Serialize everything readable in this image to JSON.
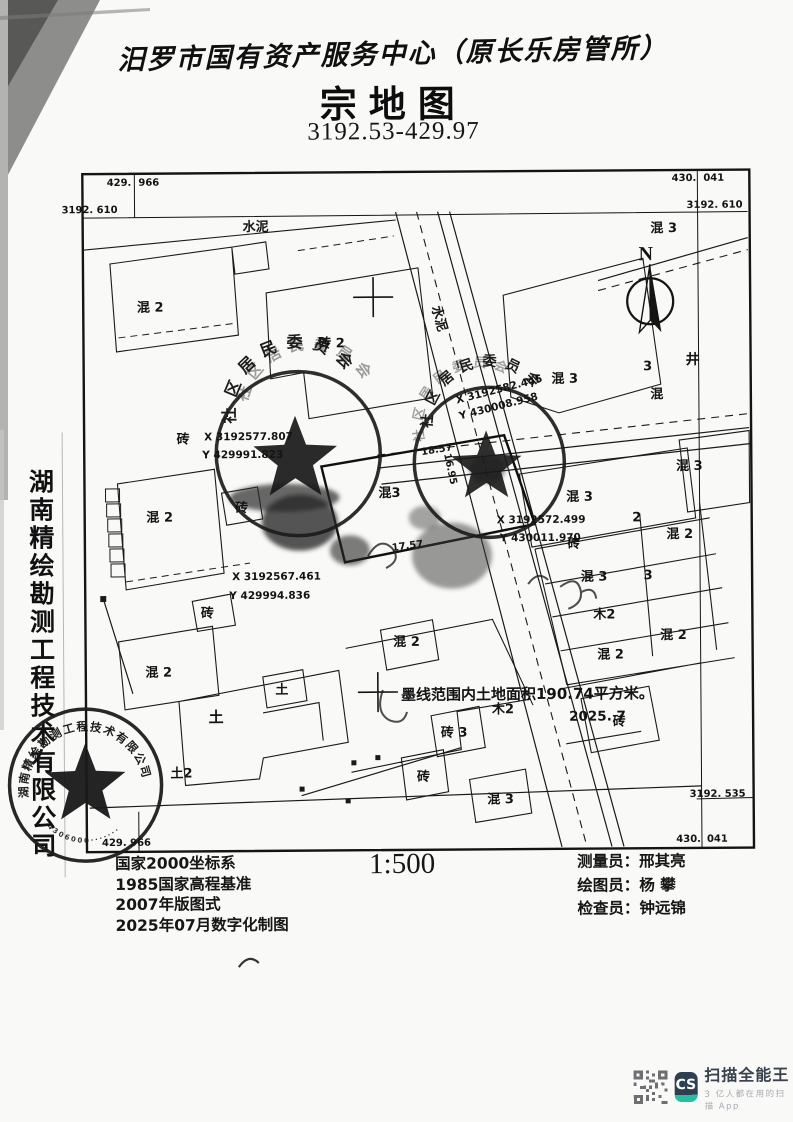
{
  "header": {
    "handwritten_title": "汨罗市国有资产服务中心（原长乐房管所）",
    "map_type": "宗地图",
    "sheet_number": "3192.53-429.97"
  },
  "sidebar": {
    "company_vertical": "湖南精绘勘测工程技术有限公司"
  },
  "map": {
    "north_label": "N",
    "stamps": {
      "left_arc": "社区居民委员会",
      "right_arc": "社区居民委员会",
      "company_arc": "湖南精绘勘测工程技术有限公司",
      "company_number": "4306000·······"
    },
    "labels": [
      {
        "t": "水泥",
        "x": 258,
        "y": 230
      },
      {
        "t": "水泥",
        "x": 437,
        "y": 320,
        "r": 74
      },
      {
        "t": "混 2",
        "x": 152,
        "y": 310
      },
      {
        "t": "砖 2",
        "x": 333,
        "y": 347
      },
      {
        "t": "混 3",
        "x": 666,
        "y": 234
      },
      {
        "t": "混 3",
        "x": 566,
        "y": 384
      },
      {
        "t": "3",
        "x": 649,
        "y": 372
      },
      {
        "t": "混",
        "x": 658,
        "y": 400
      },
      {
        "t": "井",
        "x": 694,
        "y": 366,
        "s": 14
      },
      {
        "t": "混 3",
        "x": 690,
        "y": 472
      },
      {
        "t": "砖",
        "x": 184,
        "y": 442
      },
      {
        "t": "混 2",
        "x": 160,
        "y": 520
      },
      {
        "t": "砖",
        "x": 242,
        "y": 511
      },
      {
        "t": "混3",
        "x": 390,
        "y": 497
      },
      {
        "t": "混 3",
        "x": 580,
        "y": 502
      },
      {
        "t": "2",
        "x": 637,
        "y": 523
      },
      {
        "t": "砖",
        "x": 574,
        "y": 549
      },
      {
        "t": "混 2",
        "x": 680,
        "y": 540
      },
      {
        "t": "混 3",
        "x": 594,
        "y": 582
      },
      {
        "t": "3",
        "x": 648,
        "y": 581
      },
      {
        "t": "木2",
        "x": 604,
        "y": 620
      },
      {
        "t": "混 2",
        "x": 673,
        "y": 641
      },
      {
        "t": "混 2",
        "x": 610,
        "y": 660
      },
      {
        "t": "砖",
        "x": 207,
        "y": 616
      },
      {
        "t": "混 2",
        "x": 158,
        "y": 675
      },
      {
        "t": "混 2",
        "x": 406,
        "y": 646
      },
      {
        "t": "土",
        "x": 215,
        "y": 721,
        "s": 15
      },
      {
        "t": "土",
        "x": 281,
        "y": 693
      },
      {
        "t": "土2",
        "x": 180,
        "y": 776
      },
      {
        "t": "木2",
        "x": 502,
        "y": 714
      },
      {
        "t": "砖 3",
        "x": 453,
        "y": 737
      },
      {
        "t": "砖",
        "x": 618,
        "y": 727
      },
      {
        "t": "砖",
        "x": 422,
        "y": 781
      },
      {
        "t": "混 3",
        "x": 499,
        "y": 804
      },
      {
        "t": "N",
        "x": 648,
        "y": 262,
        "s": 20,
        "serif": true
      },
      {
        "t": "X 3192577.807",
        "x": 205,
        "y": 439,
        "k": "coord"
      },
      {
        "t": "Y 429991.823",
        "x": 203,
        "y": 457,
        "k": "coord"
      },
      {
        "t": "X 3192582.445",
        "x": 458,
        "y": 404,
        "r": -14,
        "k": "coord"
      },
      {
        "t": "Y 430008.958",
        "x": 461,
        "y": 420,
        "r": -14,
        "k": "coord"
      },
      {
        "t": "X 3192572.499",
        "x": 497,
        "y": 524,
        "k": "coord"
      },
      {
        "t": "Y 430011.970",
        "x": 500,
        "y": 542,
        "k": "coord"
      },
      {
        "t": "X 3192567.461",
        "x": 232,
        "y": 579,
        "k": "coord"
      },
      {
        "t": "Y 429994.836",
        "x": 229,
        "y": 598,
        "k": "coord"
      },
      {
        "t": "18.57",
        "x": 438,
        "y": 453,
        "r": -9,
        "k": "len"
      },
      {
        "t": "17.57",
        "x": 408,
        "y": 549,
        "r": -7,
        "k": "len"
      },
      {
        "t": "16.95",
        "x": 448,
        "y": 470,
        "r": 78,
        "k": "len"
      },
      {
        "t": "429.",
        "x": 134,
        "y": 184,
        "a": "end",
        "k": "corner"
      },
      {
        "t": "966",
        "x": 141,
        "y": 184,
        "k": "corner"
      },
      {
        "t": "3192. 610",
        "x": 64,
        "y": 211,
        "k": "corner"
      },
      {
        "t": "430.",
        "x": 699,
        "y": 183,
        "a": "end",
        "k": "corner"
      },
      {
        "t": "041",
        "x": 706,
        "y": 183,
        "k": "corner"
      },
      {
        "t": "3192. 610",
        "x": 745,
        "y": 210,
        "a": "end",
        "k": "corner"
      },
      {
        "t": "3192. 535",
        "x": 744,
        "y": 799,
        "a": "end",
        "k": "corner"
      },
      {
        "t": "430.",
        "x": 699,
        "y": 844,
        "a": "end",
        "k": "corner"
      },
      {
        "t": "041",
        "x": 705,
        "y": 844,
        "k": "corner"
      },
      {
        "t": "429. 966",
        "x": 100,
        "y": 844,
        "k": "corner"
      },
      {
        "t": "墨线范围内土地面积190.74平方米。",
        "x": 400,
        "y": 700,
        "s": 15,
        "k": "note"
      },
      {
        "t": "2025. 7",
        "x": 568,
        "y": 722,
        "s": 13.5,
        "k": "note"
      }
    ]
  },
  "footer": {
    "scale": "1:500",
    "specs": [
      "国家2000坐标系",
      "1985国家高程基准",
      "2007年版图式",
      "2025年07月数字化制图"
    ],
    "staff": [
      {
        "role": "测量员：",
        "name": "邢其亮"
      },
      {
        "role": "绘图员：",
        "name": "杨  攀"
      },
      {
        "role": "检查员：",
        "name": "钟远锦"
      }
    ]
  },
  "watermark": {
    "logo": "CS",
    "brand": "扫描全能王",
    "tagline": "3 亿人都在用的扫描 App"
  }
}
